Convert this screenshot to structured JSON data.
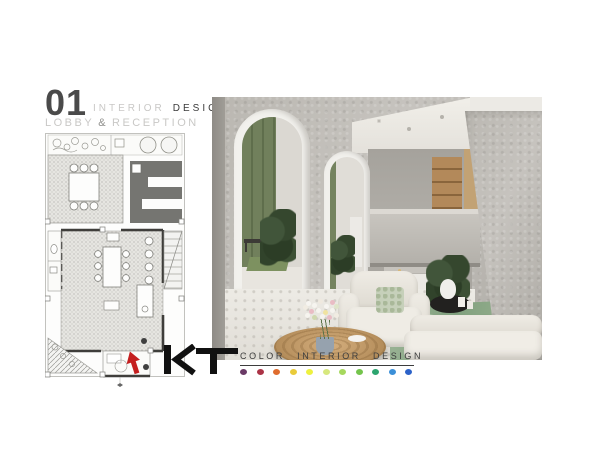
{
  "header": {
    "number": "01",
    "title_light": "INTERIOR",
    "title_dark": "DESIGN",
    "subtitle_1": "LOBBY",
    "subtitle_amp": "&",
    "subtitle_2": "RECEPTION"
  },
  "logo": {
    "mark": "KT",
    "tagline": "COLOR INTERIOR DESIGN",
    "palette": [
      "#6a3a66",
      "#ab3346",
      "#df6c2e",
      "#e9cb3a",
      "#eef13f",
      "#d7e87e",
      "#a6d85e",
      "#74c44c",
      "#2da56f",
      "#3b8fd8",
      "#2c62c9"
    ]
  },
  "plan": {
    "entry_arrow_color": "#c41f1f"
  },
  "photo": {
    "description": "Lobby and reception rendering: arched concrete walls, green feature wall, green marble reception desk, white sofas, round wooden coffee table with flowers",
    "colors": {
      "concrete": "#bab7b1",
      "green_wall": "#71805c",
      "green_marble": "#93ab8e",
      "wood": "#bb9462"
    }
  }
}
